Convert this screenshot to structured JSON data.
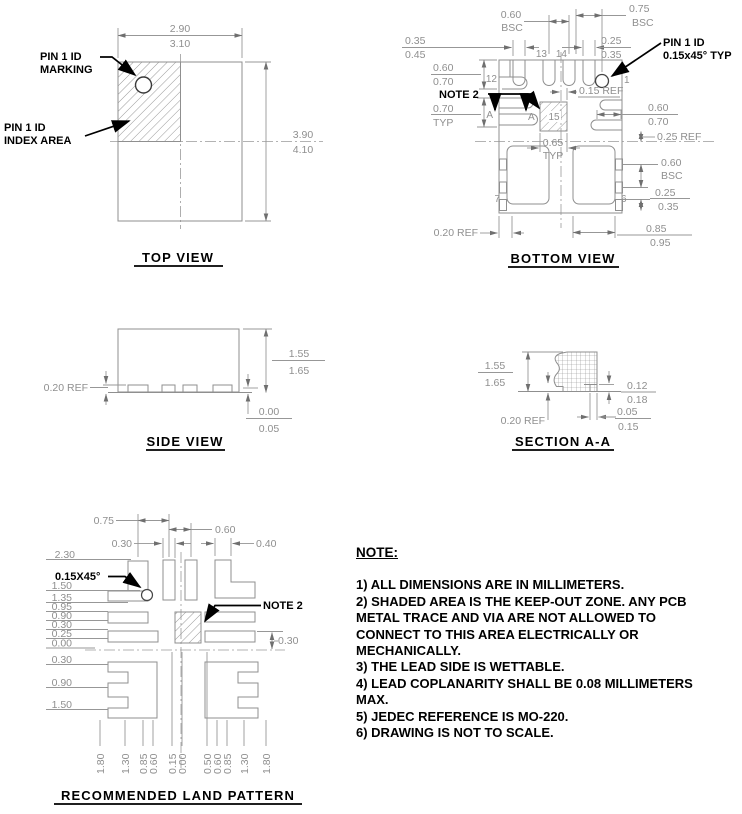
{
  "colors": {
    "drawing_gray": "#8f8f8f",
    "label_black": "#000000",
    "background": "#ffffff"
  },
  "top_view": {
    "title": "TOP VIEW",
    "width_upper": "2.90",
    "width_lower": "3.10",
    "height_upper": "3.90",
    "height_lower": "4.10",
    "marking_l1": "PIN 1 ID",
    "marking_l2": "MARKING",
    "index_l1": "PIN 1 ID",
    "index_l2": "INDEX AREA"
  },
  "bottom_view": {
    "title": "BOTTOM VIEW",
    "pin1_l1": "PIN 1 ID",
    "pin1_l2": "0.15x45° TYP",
    "note2": "NOTE 2",
    "t_060": "0.60",
    "t_bsc": "BSC",
    "t_075": "0.75",
    "t_bsc2": "BSC",
    "tl_035": "0.35",
    "tl_045": "0.45",
    "tr_025": "0.25",
    "tr_035": "0.35",
    "l_060": "0.60",
    "l_070": "0.70",
    "l_070b": "0.70",
    "l_typ": "TYP",
    "ref_015": "0.15  REF",
    "r_060": "0.60",
    "r_070": "0.70",
    "ref_025": "0.25  REF",
    "c_065": "0.65",
    "c_typ": "TYP",
    "r2_060": "0.60",
    "r2_bsc": "BSC",
    "r3_025": "0.25",
    "r3_035": "0.35",
    "b_085": "0.85",
    "b_095": "0.95",
    "ref_020": "0.20  REF",
    "sec_a": "A",
    "p1": "1",
    "p6": "6",
    "p7": "7",
    "p12": "12",
    "p13": "13",
    "p14": "14",
    "p15": "15"
  },
  "side_view": {
    "title": "SIDE VIEW",
    "ref_020": "0.20  REF",
    "d_155": "1.55",
    "d_165": "1.65",
    "d_000": "0.00",
    "d_005": "0.05"
  },
  "section_aa": {
    "title": "SECTION A-A",
    "d_155": "1.55",
    "d_165": "1.65",
    "d_012": "0.12",
    "d_018": "0.18",
    "d_005": "0.05",
    "d_015": "0.15",
    "ref_020": "0.20  REF"
  },
  "land_pattern": {
    "title": "RECOMMENDED LAND PATTERN",
    "chamfer": "0.15X45°",
    "note2": "NOTE 2",
    "top_dims": [
      "0.75",
      "0.60",
      "0.30",
      "0.40"
    ],
    "left_dims": [
      "2.30",
      "1.50",
      "1.35",
      "0.95",
      "0.90",
      "0.30",
      "0.25",
      "0.00",
      "0.30",
      "0.90",
      "1.50"
    ],
    "right_dim": "0.30",
    "bottom_dims": [
      "1.80",
      "1.30",
      "0.85",
      "0.60",
      "0.15",
      "0.00",
      "0.50",
      "0.60",
      "0.85",
      "1.30",
      "1.80"
    ]
  },
  "notes": {
    "heading": "NOTE:",
    "items": [
      "1) ALL DIMENSIONS ARE IN MILLIMETERS.",
      "2) SHADED AREA IS THE KEEP-OUT ZONE. ANY PCB METAL TRACE AND VIA ARE NOT ALLOWED TO CONNECT TO THIS AREA ELECTRICALLY OR MECHANICALLY.",
      "3) THE LEAD SIDE IS WETTABLE.",
      "4) LEAD COPLANARITY SHALL BE 0.08 MILLIMETERS MAX.",
      "5) JEDEC REFERENCE IS MO-220.",
      "6) DRAWING IS NOT TO SCALE."
    ]
  }
}
